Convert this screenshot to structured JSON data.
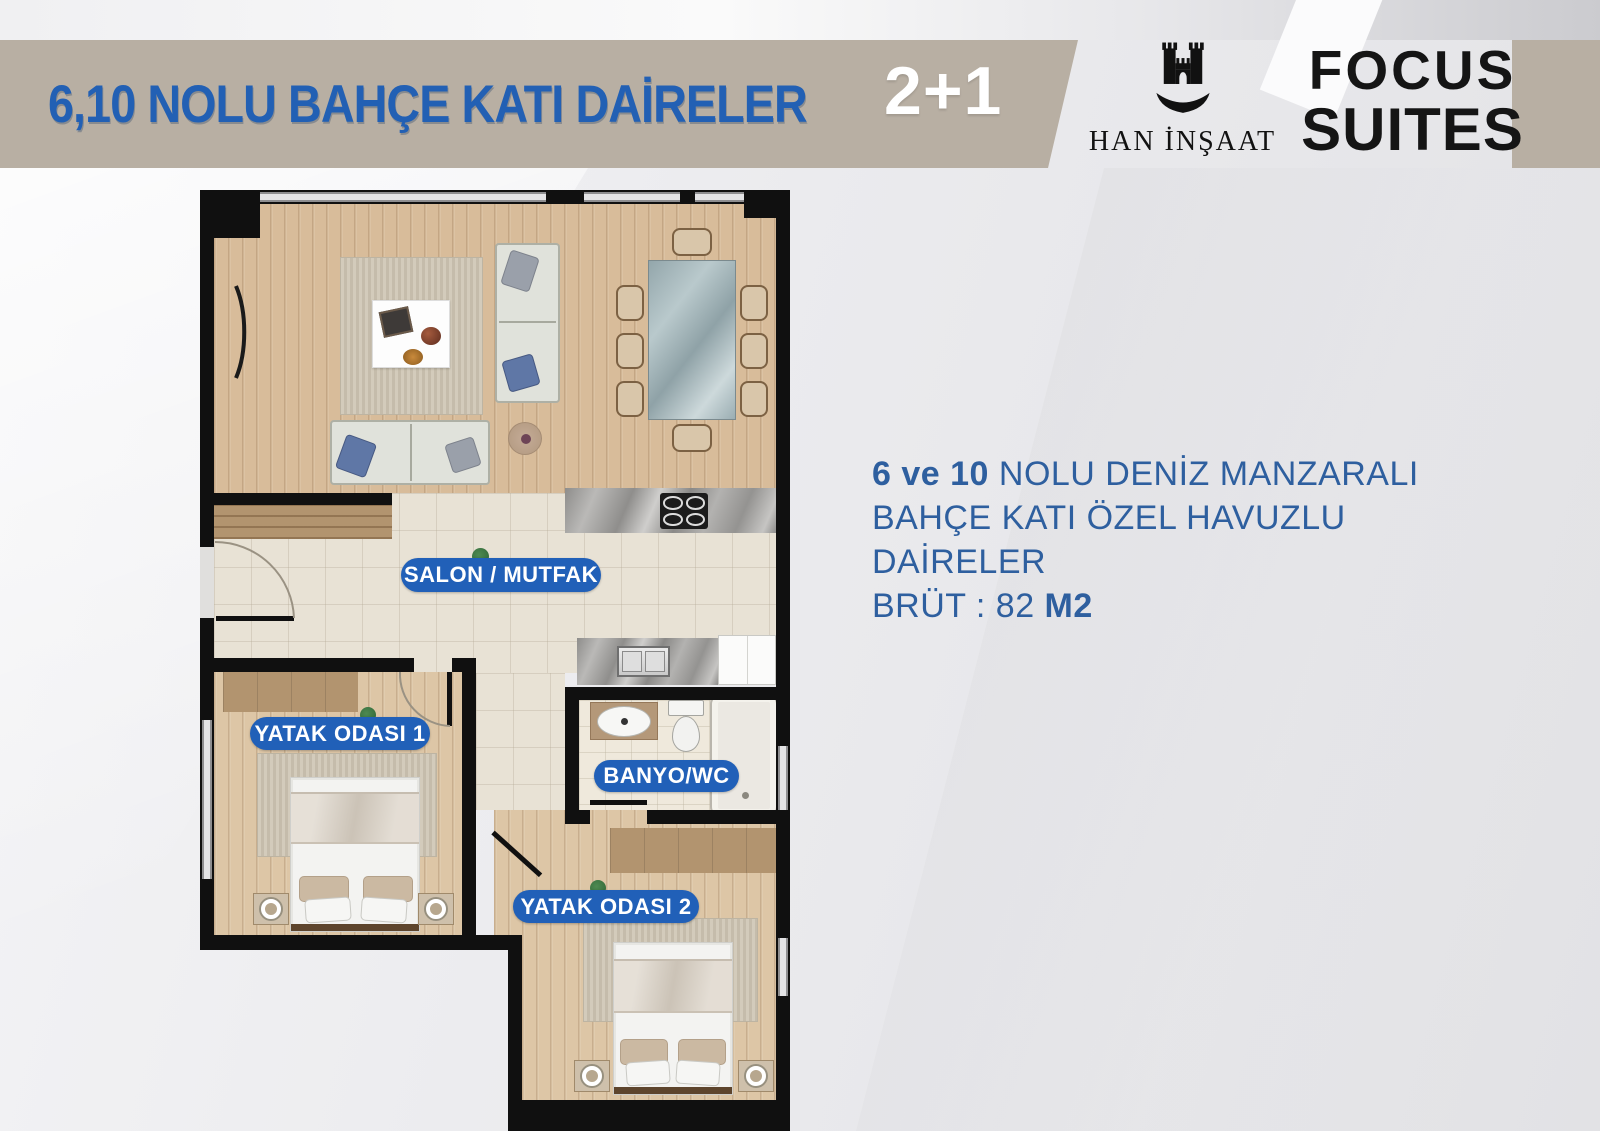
{
  "header": {
    "bar_title": "6,10 NOLU BAHÇE KATI DAİRELER",
    "unit_type": "2+1",
    "brand_name": "HAN İNŞAAT",
    "brand_word_top": "FOCUS",
    "brand_word_bottom": "SUITES"
  },
  "floor_plan": {
    "rooms": [
      {
        "id": "salon-mutfak",
        "label": "SALON / MUTFAK"
      },
      {
        "id": "yatak-odasi-1",
        "label": "YATAK ODASI 1"
      },
      {
        "id": "banyo-wc",
        "label": "BANYO/WC"
      },
      {
        "id": "yatak-odasi-2",
        "label": "YATAK ODASI 2"
      }
    ]
  },
  "description": {
    "line1_bold": "6 ve 10",
    "line1_rest": " NOLU DENİZ MANZARALI",
    "line2": "BAHÇE KATI ÖZEL HAVUZLU DAİRELER",
    "line3_regular": "BRÜT : 82 ",
    "line3_bold": "M2"
  },
  "colors": {
    "accent_blue": "#2260b4",
    "pill_blue": "#2160b8",
    "desc_blue": "#2e5f9f",
    "bar_tan": "#b8afa3",
    "wall_black": "#101010"
  }
}
